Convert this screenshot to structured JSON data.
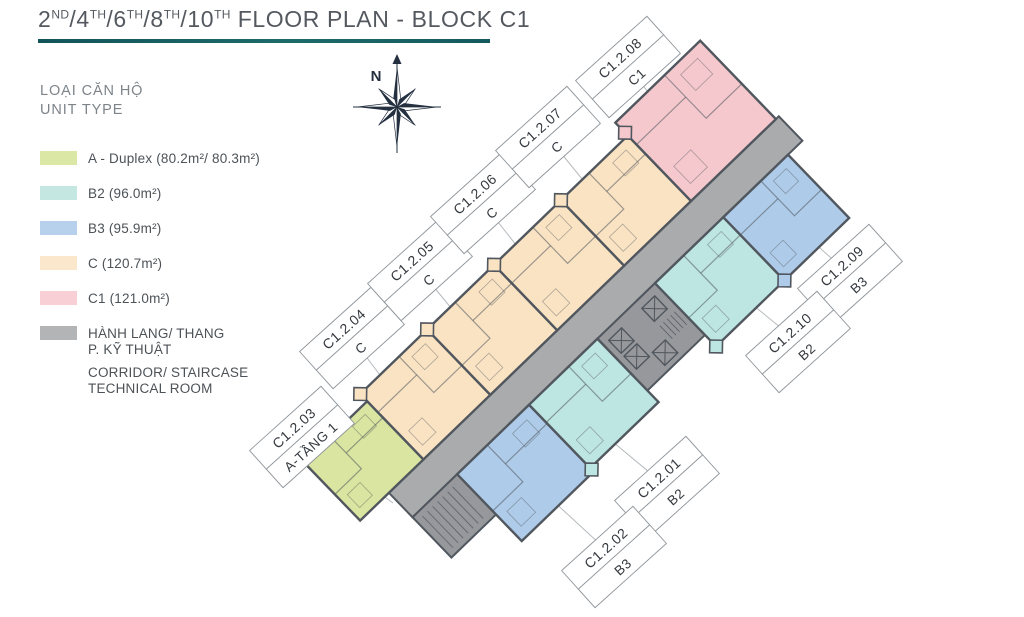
{
  "title": {
    "segments": [
      {
        "text": "2",
        "sup": "ND"
      },
      {
        "text": "/4",
        "sup": "TH"
      },
      {
        "text": "/6",
        "sup": "TH"
      },
      {
        "text": "/8",
        "sup": "TH"
      },
      {
        "text": "/10",
        "sup": "TH"
      },
      {
        "text": " FLOOR PLAN - BLOCK C1",
        "sup": ""
      }
    ]
  },
  "legend": {
    "heading_vi": "LOẠI CĂN HỘ",
    "heading_en": "UNIT TYPE",
    "items": [
      {
        "key": "A",
        "color": "#dbe7a4",
        "label": "A - Duplex (80.2m²/ 80.3m²)"
      },
      {
        "key": "B2",
        "color": "#c4e7e2",
        "label": "B2 (96.0m²)"
      },
      {
        "key": "B3",
        "color": "#b7d0ec",
        "label": "B3 (95.9m²)"
      },
      {
        "key": "C",
        "color": "#fbe7cc",
        "label": "C (120.7m²)"
      },
      {
        "key": "C1",
        "color": "#f8cfd4",
        "label": "C1 (121.0m²)"
      },
      {
        "key": "corridor",
        "color": "#b2b4b6",
        "lines_vi": [
          "HÀNH LANG/ THANG",
          "P. KỸ THUẬT"
        ],
        "lines_en": [
          "CORRIDOR/ STAIRCASE",
          "TECHNICAL ROOM"
        ]
      }
    ]
  },
  "compass": {
    "label": "N"
  },
  "plan": {
    "rotation_deg": -44,
    "label_rotation_deg": -42,
    "center": {
      "x": 582,
      "y": 330
    },
    "colors": {
      "A": "#d9e5a0",
      "B2": "#bde5e1",
      "B3": "#aecbe9",
      "C": "#fae3c3",
      "C1": "#f4c8cd",
      "corridor": "#a9abad",
      "technical": "#96989c",
      "wall": "#51575e"
    },
    "corridor": {
      "x": -252,
      "y": -17,
      "w": 542,
      "h": 34
    },
    "stair_stub": {
      "x": -252,
      "y": 17,
      "w": 62,
      "h": 56
    },
    "technical": {
      "x": 5,
      "y": 17,
      "w": 80,
      "h": 72
    },
    "units": [
      {
        "code": "C1.2.03",
        "type": "A",
        "x": -292,
        "y": -98,
        "w": 88,
        "h": 81
      },
      {
        "code": "C1.2.04",
        "type": "C",
        "x": -204,
        "y": -108,
        "w": 93,
        "h": 91
      },
      {
        "code": "C1.2.05",
        "type": "C",
        "x": -111,
        "y": -108,
        "w": 93,
        "h": 91
      },
      {
        "code": "C1.2.06",
        "type": "C",
        "x": -18,
        "y": -108,
        "w": 93,
        "h": 91
      },
      {
        "code": "C1.2.07",
        "type": "C",
        "x": 75,
        "y": -108,
        "w": 93,
        "h": 91
      },
      {
        "code": "C1.2.08",
        "type": "C1",
        "x": 168,
        "y": -126,
        "w": 118,
        "h": 109
      },
      {
        "code": "C1.2.02",
        "type": "B3",
        "x": -190,
        "y": 17,
        "w": 100,
        "h": 93
      },
      {
        "code": "C1.2.01",
        "type": "B2",
        "x": -90,
        "y": 17,
        "w": 95,
        "h": 88
      },
      {
        "code": "C1.2.10",
        "type": "B2",
        "x": 85,
        "y": 17,
        "w": 95,
        "h": 88
      },
      {
        "code": "C1.2.09",
        "type": "B3",
        "x": 180,
        "y": 17,
        "w": 90,
        "h": 88
      }
    ],
    "bumps": [
      {
        "x": -204,
        "y": -108,
        "c": "C"
      },
      {
        "x": -111,
        "y": -108,
        "c": "C"
      },
      {
        "x": -18,
        "y": -108,
        "c": "C"
      },
      {
        "x": 75,
        "y": -108,
        "c": "C"
      },
      {
        "x": 168,
        "y": -112,
        "c": "C1"
      },
      {
        "x": -90,
        "y": 107,
        "c": "B2"
      },
      {
        "x": 85,
        "y": 105,
        "c": "B2"
      },
      {
        "x": 180,
        "y": 105,
        "c": "B3"
      }
    ],
    "labels": [
      {
        "code": "C1.2.01",
        "type": "B2",
        "x": 667,
        "y": 487,
        "tx": 607,
        "ty": 437
      },
      {
        "code": "C1.2.02",
        "type": "B3",
        "x": 614,
        "y": 557,
        "tx": 538,
        "ty": 487
      },
      {
        "code": "C1.2.03",
        "type": "A-TẦNG 1",
        "x": 302,
        "y": 437,
        "tx": 393,
        "ty": 503
      },
      {
        "code": "C1.2.04",
        "type": "C",
        "x": 352,
        "y": 338,
        "tx": 420,
        "ty": 428
      },
      {
        "code": "C1.2.05",
        "type": "C",
        "x": 420,
        "y": 270,
        "tx": 487,
        "ty": 352
      },
      {
        "code": "C1.2.06",
        "type": "C",
        "x": 483,
        "y": 203,
        "tx": 550,
        "ty": 288
      },
      {
        "code": "C1.2.07",
        "type": "C",
        "x": 548,
        "y": 137,
        "tx": 617,
        "ty": 222
      },
      {
        "code": "C1.2.08",
        "type": "C1",
        "x": 628,
        "y": 67,
        "tx": 695,
        "ty": 150
      },
      {
        "code": "C1.2.09",
        "type": "B3",
        "x": 850,
        "y": 275,
        "tx": 772,
        "ty": 205
      },
      {
        "code": "C1.2.10",
        "type": "B2",
        "x": 798,
        "y": 342,
        "tx": 725,
        "ty": 282
      }
    ]
  }
}
